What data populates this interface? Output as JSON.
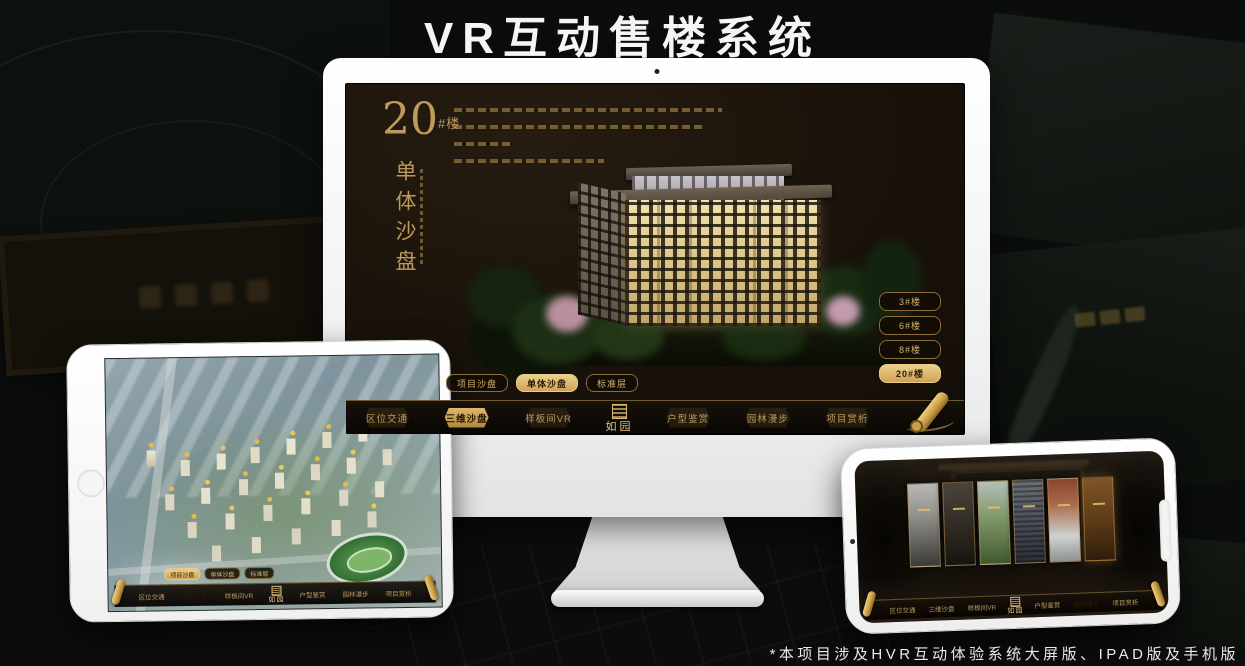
{
  "page": {
    "title": "VR互动售楼系统",
    "footnote": "*本项目涉及HVR互动体验系统大屏版、IPAD版及手机版"
  },
  "colors": {
    "gold_accent": "#c9a265",
    "gold_active": "#d9b266",
    "screen_background": "#1a130b",
    "nav_background": "#0d0904",
    "title_text": "#f5f5f5"
  },
  "monitor_app": {
    "heading": {
      "number": "20",
      "unit": "#楼",
      "subtitle": "单体沙盘"
    },
    "floor_buttons": [
      {
        "label": "3#楼",
        "active": false
      },
      {
        "label": "6#楼",
        "active": false
      },
      {
        "label": "8#楼",
        "active": false
      },
      {
        "label": "20#楼",
        "active": true
      }
    ],
    "view_tabs": [
      {
        "label": "项目沙盘",
        "active": false
      },
      {
        "label": "单体沙盘",
        "active": true
      },
      {
        "label": "标准层",
        "active": false
      }
    ],
    "nav": {
      "left_items": [
        {
          "label": "区位交通",
          "active": false
        },
        {
          "label": "三维沙盘",
          "active": true
        },
        {
          "label": "样板间VR",
          "active": false
        }
      ],
      "logo": "如园",
      "right_items": [
        {
          "label": "户型鉴赏",
          "active": false
        },
        {
          "label": "园林漫步",
          "active": false
        },
        {
          "label": "项目赏析",
          "active": false
        }
      ]
    }
  },
  "tablet_app": {
    "view_tabs": [
      {
        "label": "项目沙盘",
        "active": true
      },
      {
        "label": "单体沙盘",
        "active": false
      },
      {
        "label": "标准层",
        "active": false
      }
    ],
    "nav": {
      "left_items": [
        {
          "label": "区位交通",
          "active": false
        },
        {
          "label": "三维沙盘",
          "active": true
        },
        {
          "label": "样板间VR",
          "active": false
        }
      ],
      "logo": "如园",
      "right_items": [
        {
          "label": "户型鉴赏",
          "active": false
        },
        {
          "label": "园林漫步",
          "active": false
        },
        {
          "label": "项目赏析",
          "active": false
        }
      ]
    }
  },
  "phone_app": {
    "nav": {
      "left_items": [
        {
          "label": "区位交通",
          "active": false
        },
        {
          "label": "三维沙盘",
          "active": false
        },
        {
          "label": "样板间VR",
          "active": false
        }
      ],
      "logo": "如园",
      "right_items": [
        {
          "label": "户型鉴赏",
          "active": false
        },
        {
          "label": "园林漫步",
          "active": true
        },
        {
          "label": "项目赏析",
          "active": false
        }
      ]
    },
    "gallery_panels": [
      "courtyard-gray",
      "garage-dark",
      "garden-green",
      "building-facade",
      "autumn-court",
      "study-warm"
    ]
  }
}
